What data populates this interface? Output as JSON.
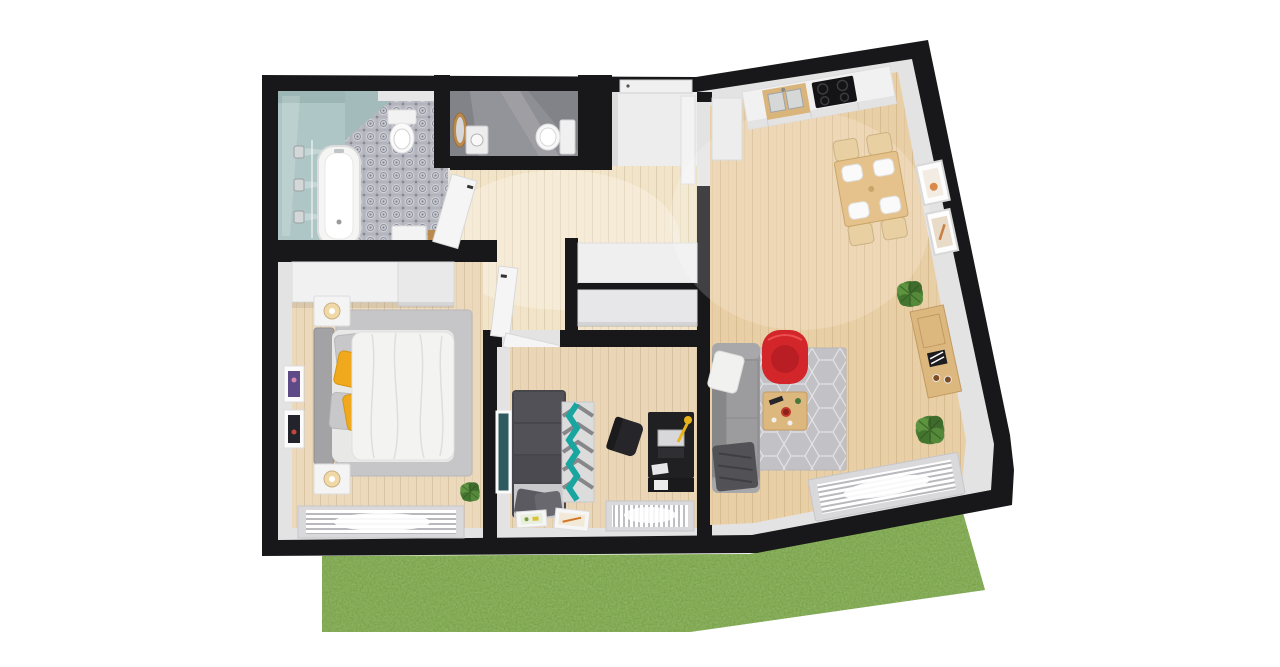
{
  "palette": {
    "background": "#ffffff",
    "wall": "#18181a",
    "wall_face": "#e3e3e4",
    "floor_living": "#e9cfa6",
    "floor_bedroom": "#ecd9bb",
    "floor_office": "#ead6b6",
    "floor_hall": "#f2e4c8",
    "floor_alcove": "#ededee",
    "floor_wc": "#828389",
    "tile_base": "#bcbdc4",
    "bathroom_teal": "#aec6c5",
    "grass": "#6f9c40",
    "sofa_gray": "#98989a",
    "office_sofa": "#46464b",
    "rug_gray": "#c2c2c6",
    "rug_bedroom": "#c6c6c9",
    "chair_red": "#d2262b",
    "pillow_yellow": "#f0a81c",
    "rug_teal": "#19a6a0",
    "wood_furniture": "#ddb87e",
    "desk_black": "#202023",
    "white_furniture": "#f1f1f1",
    "duvet_white": "#f3f3f2",
    "plant_green": "#4c7d35",
    "window_frame": "#d9d9db"
  },
  "scene": {
    "type": "3d-floor-plan-top-down-render",
    "rooms": [
      {
        "name": "bathroom",
        "furniture": [
          "bathtub",
          "toilet",
          "shower-heads",
          "vanity-cabinet",
          "patterned-tile-floor",
          "teal-shower-zone"
        ]
      },
      {
        "name": "wc-storage",
        "furniture": [
          "toilet",
          "washbasin",
          "wood-mirror"
        ]
      },
      {
        "name": "entry-vestibule",
        "furniture": [
          "entry-door"
        ]
      },
      {
        "name": "hallway",
        "furniture": [
          "built-in-closet",
          "bathroom-door",
          "bedroom-door",
          "office-door",
          "living-room-door"
        ]
      },
      {
        "name": "kitchen-living-room",
        "furniture": [
          "kitchen-counter",
          "double-sink",
          "cooktop",
          "tall-cabinet",
          "dining-table",
          "dining-chairs",
          "wall-frames",
          "sideboard",
          "potted-plants",
          "gray-sofa",
          "red-armchair",
          "coffee-table",
          "hex-pattern-rug",
          "window-radiator"
        ]
      },
      {
        "name": "bedroom",
        "furniture": [
          "double-bed",
          "yellow-pillows",
          "wardrobe",
          "nightstands",
          "table-lamps",
          "wall-frames",
          "area-rug",
          "window-radiator",
          "potted-plant"
        ]
      },
      {
        "name": "office",
        "furniture": [
          "dark-sofa",
          "chevron-rug",
          "desk",
          "desk-chair",
          "desk-lamp",
          "leaning-art-frame",
          "floor-frames",
          "window-radiator"
        ]
      }
    ],
    "environment": [
      "grass-lawn",
      "white-background"
    ]
  }
}
